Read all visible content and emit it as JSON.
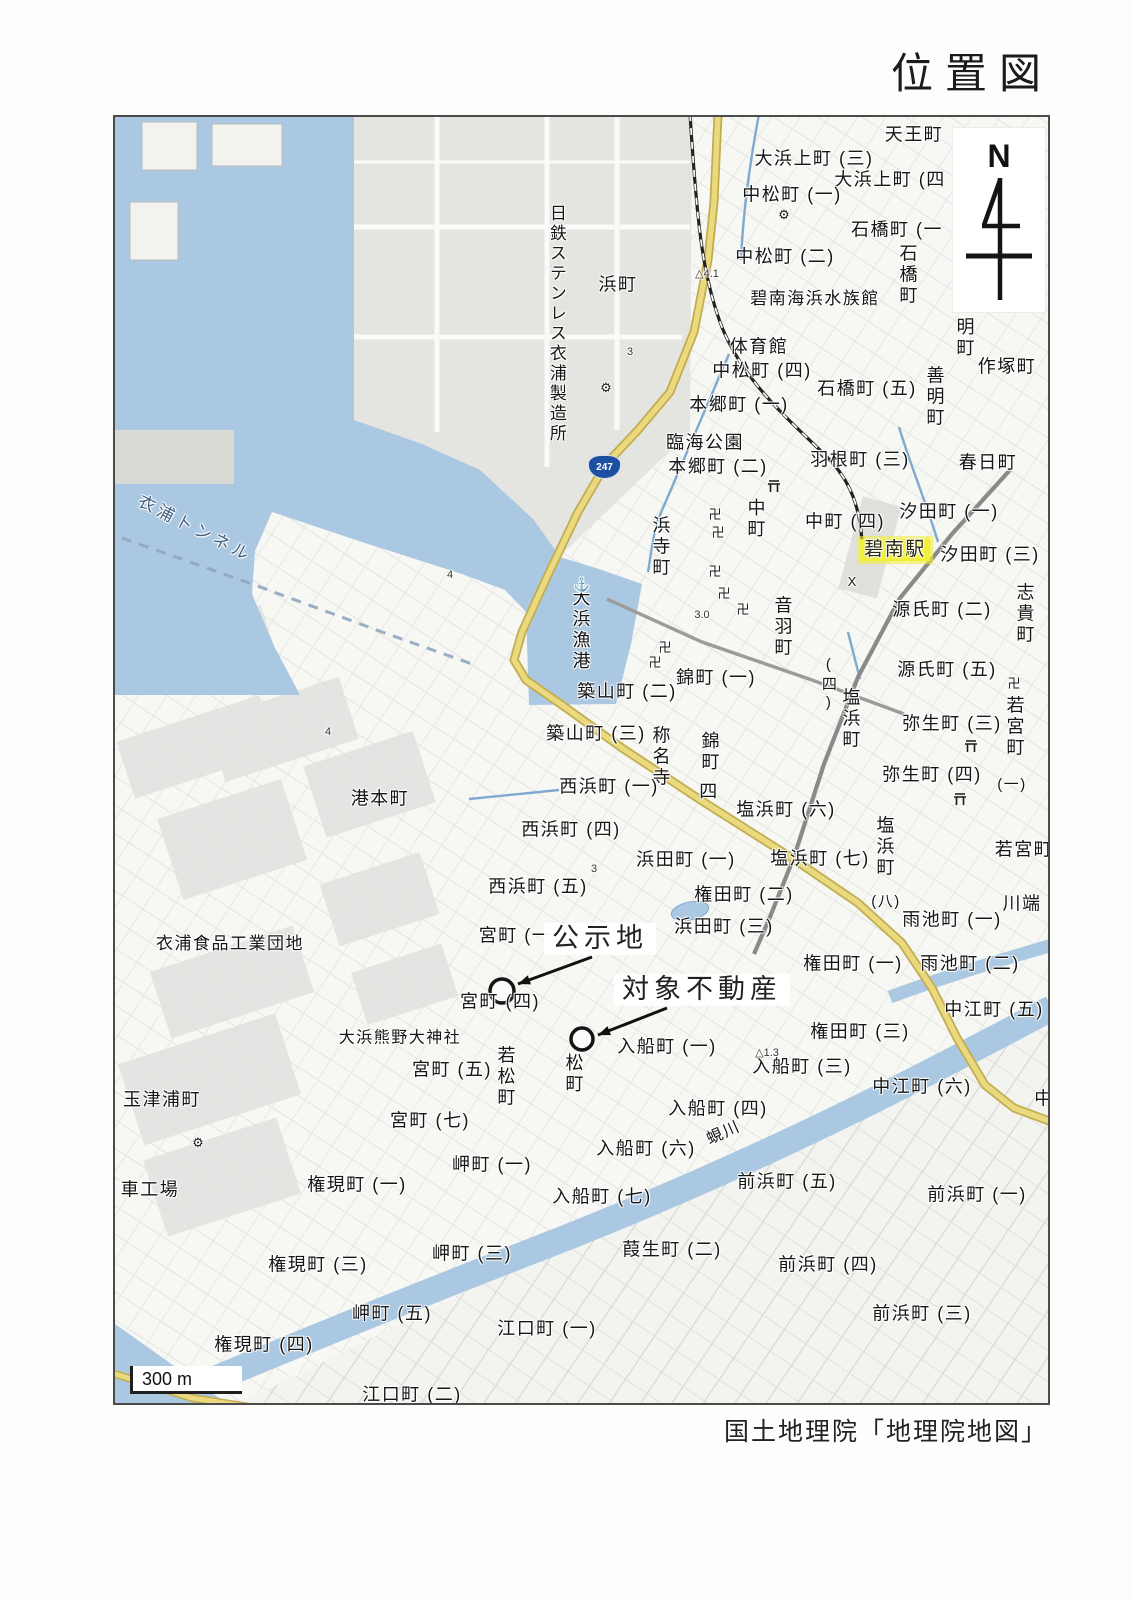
{
  "page": {
    "title": "位置図",
    "credit": "国土地理院「地理院地図」"
  },
  "map": {
    "compass_label": "N",
    "scale_label": "300 m",
    "route_shield": "247",
    "colors": {
      "water": "#abc8e2",
      "land": "#f7f7f4",
      "industrial": "#e3e3e0",
      "road_yellow": "#ead97f",
      "road_yellow_edge": "#c2ad4e",
      "rail": "#222222",
      "shield_blue": "#1d50a2",
      "station_highlight": "#f2ef3a"
    },
    "annotations": {
      "public_notice_site": "公示地",
      "subject_property": "対象不動産"
    },
    "station": {
      "name": "碧南駅"
    },
    "labels": [
      {
        "t": "天王町",
        "x": 912,
        "y": 133
      },
      {
        "t": "大浜上町 (三)",
        "x": 812,
        "y": 157
      },
      {
        "t": "大浜上町 (四",
        "x": 888,
        "y": 178
      },
      {
        "t": "中松町 (一)",
        "x": 790,
        "y": 193
      },
      {
        "t": "石橋町 (一",
        "x": 895,
        "y": 228
      },
      {
        "t": "中松町 (二)",
        "x": 783,
        "y": 255
      },
      {
        "t": "碧南海浜水族館",
        "x": 813,
        "y": 297,
        "s": 17
      },
      {
        "t": "体育館",
        "x": 757,
        "y": 345
      },
      {
        "t": "中松町 (四)",
        "x": 760,
        "y": 369
      },
      {
        "t": "石橋町 (五)",
        "x": 865,
        "y": 387
      },
      {
        "t": "作塚町",
        "x": 1005,
        "y": 365
      },
      {
        "t": "本郷町 (一)",
        "x": 737,
        "y": 403
      },
      {
        "t": "臨海公園",
        "x": 703,
        "y": 441
      },
      {
        "t": "本郷町 (二)",
        "x": 716,
        "y": 465
      },
      {
        "t": "羽根町 (三)",
        "x": 858,
        "y": 458
      },
      {
        "t": "春日町",
        "x": 986,
        "y": 461
      },
      {
        "t": "汐田町 (一)",
        "x": 947,
        "y": 510
      },
      {
        "t": "中町 (四)",
        "x": 843,
        "y": 520
      },
      {
        "t": "汐田町 (三)",
        "x": 988,
        "y": 553
      },
      {
        "t": "源氏町 (二)",
        "x": 940,
        "y": 608
      },
      {
        "t": "源氏町 (五)",
        "x": 945,
        "y": 668
      },
      {
        "t": "弥生町 (三)",
        "x": 950,
        "y": 722
      },
      {
        "t": "弥生町 (四)",
        "x": 930,
        "y": 773
      },
      {
        "t": "(一)",
        "x": 1010,
        "y": 783,
        "s": 15
      },
      {
        "t": "塩浜町 (六)",
        "x": 784,
        "y": 808
      },
      {
        "t": "若宮町",
        "x": 1022,
        "y": 848
      },
      {
        "t": "塩浜町 (七)",
        "x": 818,
        "y": 857
      },
      {
        "t": "(八)",
        "x": 884,
        "y": 900,
        "s": 15
      },
      {
        "t": "権田町 (二)",
        "x": 742,
        "y": 893
      },
      {
        "t": "川端",
        "x": 1020,
        "y": 902
      },
      {
        "t": "雨池町 (一)",
        "x": 950,
        "y": 918
      },
      {
        "t": "権田町 (一)",
        "x": 851,
        "y": 962
      },
      {
        "t": "雨池町 (二)",
        "x": 968,
        "y": 962
      },
      {
        "t": "中江町 (五)",
        "x": 992,
        "y": 1008
      },
      {
        "t": "権田町 (三)",
        "x": 858,
        "y": 1030
      },
      {
        "t": "中江町 (六)",
        "x": 920,
        "y": 1085
      },
      {
        "t": "中",
        "x": 1042,
        "y": 1097
      },
      {
        "t": "浜田町 (一)",
        "x": 684,
        "y": 858
      },
      {
        "t": "浜田町 (三)",
        "x": 722,
        "y": 925
      },
      {
        "t": "西浜町 (一)",
        "x": 607,
        "y": 785
      },
      {
        "t": "西浜町 (四)",
        "x": 569,
        "y": 828
      },
      {
        "t": "西浜町 (五)",
        "x": 536,
        "y": 885
      },
      {
        "t": "宮町 (一",
        "x": 513,
        "y": 934
      },
      {
        "t": "宮町 (四)",
        "x": 498,
        "y": 1000
      },
      {
        "t": "宮町 (五)",
        "x": 450,
        "y": 1068
      },
      {
        "t": "宮町 (七)",
        "x": 428,
        "y": 1119
      },
      {
        "t": "大浜熊野大神社",
        "x": 398,
        "y": 1037,
        "s": 16
      },
      {
        "t": "玉津浦町",
        "x": 160,
        "y": 1098
      },
      {
        "t": "車工場",
        "x": 148,
        "y": 1188
      },
      {
        "t": "衣浦食品工業団地",
        "x": 228,
        "y": 942,
        "s": 17
      },
      {
        "t": "港本町",
        "x": 378,
        "y": 797
      },
      {
        "t": "築山町 (二)",
        "x": 625,
        "y": 690
      },
      {
        "t": "築山町 (三)",
        "x": 594,
        "y": 732
      },
      {
        "t": "錦町 (一)",
        "x": 714,
        "y": 676
      },
      {
        "t": "四",
        "x": 707,
        "y": 790
      },
      {
        "t": "入船町 (一)",
        "x": 665,
        "y": 1045
      },
      {
        "t": "入船町 (三)",
        "x": 800,
        "y": 1065
      },
      {
        "t": "入船町 (四)",
        "x": 716,
        "y": 1107
      },
      {
        "t": "入船町 (六)",
        "x": 644,
        "y": 1147
      },
      {
        "t": "入船町 (七)",
        "x": 600,
        "y": 1195
      },
      {
        "t": "前浜町 (五)",
        "x": 785,
        "y": 1180
      },
      {
        "t": "前浜町 (一)",
        "x": 975,
        "y": 1193
      },
      {
        "t": "前浜町 (四)",
        "x": 826,
        "y": 1263
      },
      {
        "t": "前浜町 (三)",
        "x": 920,
        "y": 1312
      },
      {
        "t": "葭生町 (二)",
        "x": 670,
        "y": 1248
      },
      {
        "t": "江口町 (一)",
        "x": 545,
        "y": 1327
      },
      {
        "t": "江口町 (二)",
        "x": 410,
        "y": 1393
      },
      {
        "t": "岬町 (一)",
        "x": 490,
        "y": 1163
      },
      {
        "t": "岬町 (三)",
        "x": 470,
        "y": 1252
      },
      {
        "t": "岬町 (五)",
        "x": 390,
        "y": 1312
      },
      {
        "t": "権現町 (一)",
        "x": 355,
        "y": 1183
      },
      {
        "t": "権現町 (三)",
        "x": 316,
        "y": 1263
      },
      {
        "t": "権現町 (四)",
        "x": 262,
        "y": 1343
      },
      {
        "t": "浜町",
        "x": 616,
        "y": 283
      },
      {
        "t": "石橋町",
        "x": 905,
        "y": 273,
        "v": 1
      },
      {
        "t": "明町",
        "x": 962,
        "y": 336,
        "v": 1
      },
      {
        "t": "善明町",
        "x": 932,
        "y": 395,
        "v": 1
      },
      {
        "t": "音羽町",
        "x": 780,
        "y": 625,
        "v": 1
      },
      {
        "t": "志貴町",
        "x": 1022,
        "y": 612,
        "v": 1
      },
      {
        "t": "中町",
        "x": 753,
        "y": 517,
        "v": 1
      },
      {
        "t": "浜寺町",
        "x": 658,
        "y": 545,
        "v": 1
      },
      {
        "t": "称名寺",
        "x": 658,
        "y": 755,
        "v": 1
      },
      {
        "t": "錦町",
        "x": 707,
        "y": 750,
        "v": 1
      },
      {
        "t": "(四)",
        "x": 826,
        "y": 683,
        "v": 1,
        "s": 15
      },
      {
        "t": "塩浜町",
        "x": 848,
        "y": 717,
        "v": 1
      },
      {
        "t": "若宮町",
        "x": 1012,
        "y": 725,
        "v": 1
      },
      {
        "t": "塩浜町",
        "x": 882,
        "y": 845,
        "v": 1
      },
      {
        "t": "大浜漁港",
        "x": 578,
        "y": 628,
        "v": 1
      },
      {
        "t": "日鉄ステンレス衣浦製造所",
        "x": 554,
        "y": 322,
        "v": 1,
        "s": 17
      },
      {
        "t": "若松町",
        "x": 503,
        "y": 1075,
        "v": 1
      },
      {
        "t": "松町",
        "x": 571,
        "y": 1072,
        "v": 1
      },
      {
        "t": "衣浦トンネル",
        "x": 193,
        "y": 527,
        "r": 27,
        "k": "wname"
      },
      {
        "t": "蜆川",
        "x": 722,
        "y": 1132,
        "r": -24,
        "s": 16
      },
      {
        "t": "碧南駅",
        "x": 893,
        "y": 548,
        "k": "sta"
      },
      {
        "t": "公示地",
        "x": 598,
        "y": 937,
        "k": "anno"
      },
      {
        "t": "対象不動産",
        "x": 700,
        "y": 988,
        "k": "anno"
      },
      {
        "t": "卍",
        "x": 713,
        "y": 513,
        "k": "sym"
      },
      {
        "t": "卍",
        "x": 716,
        "y": 531,
        "k": "sym"
      },
      {
        "t": "卍",
        "x": 713,
        "y": 570,
        "k": "sym"
      },
      {
        "t": "卍",
        "x": 722,
        "y": 592,
        "k": "sym"
      },
      {
        "t": "卍",
        "x": 741,
        "y": 608,
        "k": "sym"
      },
      {
        "t": "卍",
        "x": 663,
        "y": 646,
        "k": "sym"
      },
      {
        "t": "卍",
        "x": 653,
        "y": 661,
        "k": "sym"
      },
      {
        "t": "卍",
        "x": 1012,
        "y": 682,
        "k": "sym"
      },
      {
        "t": "⚓",
        "x": 580,
        "y": 583,
        "k": "sym"
      },
      {
        "t": "⚙",
        "x": 604,
        "y": 386,
        "k": "sym"
      },
      {
        "t": "⚙",
        "x": 196,
        "y": 1141,
        "k": "sym"
      },
      {
        "t": "⚙",
        "x": 782,
        "y": 213,
        "k": "sym"
      },
      {
        "t": "X",
        "x": 850,
        "y": 580,
        "k": "sym"
      },
      {
        "t": "4",
        "x": 448,
        "y": 574,
        "k": "num"
      },
      {
        "t": "4",
        "x": 326,
        "y": 731,
        "k": "num"
      },
      {
        "t": "3.0",
        "x": 700,
        "y": 614,
        "k": "num"
      },
      {
        "t": "3",
        "x": 628,
        "y": 351,
        "k": "num"
      },
      {
        "t": "3",
        "x": 592,
        "y": 868,
        "k": "num"
      },
      {
        "t": "△4.1",
        "x": 705,
        "y": 273,
        "k": "num"
      },
      {
        "t": "△1.3",
        "x": 765,
        "y": 1052,
        "k": "num"
      }
    ],
    "markers": {
      "site_circles": [
        {
          "x": 500,
          "y": 989,
          "r": 12
        },
        {
          "x": 580,
          "y": 1037,
          "r": 11
        }
      ],
      "arrows": [
        {
          "x1": 590,
          "y1": 955,
          "x2": 516,
          "y2": 982
        },
        {
          "x1": 665,
          "y1": 1006,
          "x2": 596,
          "y2": 1033
        }
      ],
      "torii": [
        [
          772,
          486
        ],
        [
          969,
          746
        ],
        [
          958,
          799
        ]
      ]
    }
  }
}
